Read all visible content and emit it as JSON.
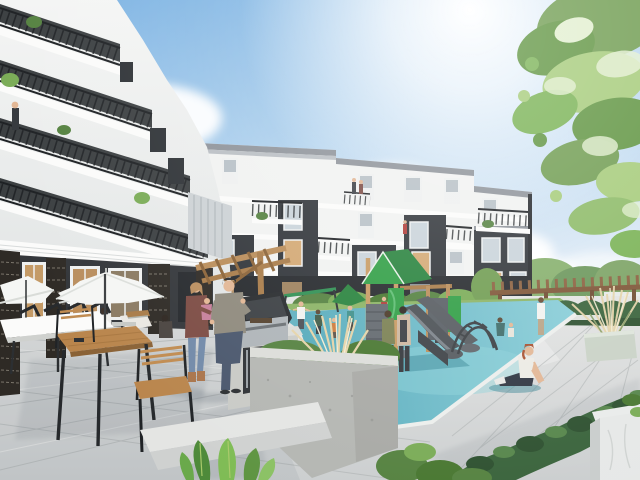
{
  "image": {
    "kind": "architectural-rendering",
    "description": "Sunlit courtyard of a modern four-storey apartment complex: white wing with cascading black-railed balconies at left, white-and-charcoal apartment block behind, patio with white umbrellas, tables and outdoor barbecue, children's playground with green-roofed timber play structure and double slide on blue rubber surfacing, wood pergola and hedges at right, tree canopy overhanging from the top right under a bright sun"
  },
  "palette": {
    "sky_top": "#79b1e2",
    "sky_mid": "#a8cdec",
    "sky_horizon": "#ddeaf6",
    "sun_glare": "#ffffff",
    "cloud": "#f6fafd",
    "building_white": "#f1f2f1",
    "building_bright": "#fbfbfa",
    "building_shade": "#dfe3e4",
    "charcoal": "#2f3338",
    "charcoal_dark": "#24272b",
    "parapet_gray": "#8d9299",
    "railing_black": "#1c1f22",
    "window_glass": "#c9d3da",
    "window_blind": "#b7c0c6",
    "window_frame": "#eef0f0",
    "window_lit": "#d3a873",
    "brick_dark": "#2e2a25",
    "brick_mortar": "#c8c0b2",
    "siding_gray": "#ccd1d4",
    "paver_light": "#d9dbdb",
    "paver_joint": "#a9aeae",
    "paver_sunlit": "#ecedec",
    "ground_shade": "#5a6570",
    "playground_blue": "#69b9c6",
    "playground_blue_deep": "#4fa6b6",
    "playground_blue_light": "#8ed2da",
    "play_green": "#2f9e44",
    "play_green_dark": "#27823c",
    "wood_post": "#c89a62",
    "wood_dark": "#a87b48",
    "slide_gray": "#4a4f54",
    "slide_gray_light": "#7b8289",
    "pergola_wood": "#8a5f3d",
    "lawn_green": "#8ab364",
    "bush_green": "#54813f",
    "bush_green_light": "#79ab55",
    "hedge_green": "#38623a",
    "tree_green": "#6f9c50",
    "tree_green_light": "#a5cb79",
    "tree_green_pale": "#e2efcf",
    "branch_brown": "#5d4228",
    "planter_concrete": "#c6c8c4",
    "planter_sage": "#c9d2c6",
    "marble_white": "#e9ebea",
    "grass_plume": "#e4d3a8",
    "daisy_white": "#ffffff",
    "umbrella_white": "#f5f6f4",
    "table_wood": "#b9854c",
    "skin": "#e2b694",
    "man_shirt": "#8e897c",
    "man_jeans": "#49566c",
    "woman_cardigan": "#7c4b43",
    "woman_jeans": "#7189a8",
    "toddler_pink": "#c77f9b",
    "sitting_hair_auburn": "#a8502f",
    "grill_steel": "#aeb4b8",
    "grill_black": "#26292c"
  },
  "scene": {
    "sky": {
      "label": "blue sky with bright sun glare and soft clouds"
    },
    "left_building": {
      "label": "white apartment wing with cascading black-railed balconies seen from below"
    },
    "center_building": {
      "label": "four-storey apartment block with alternating white and charcoal bays, balconies and windows"
    },
    "tree": {
      "label": "leafy tree canopy overhanging from the top right corner"
    },
    "courtyard": {
      "label": "grey paver patio with white umbrellas, wood dining tables, chairs and a white community table"
    },
    "outdoor_kitchen": {
      "label": "built-in stainless barbecue grill in a stone counter beneath a slatted wood shade"
    },
    "playground": {
      "label": "timber play tower with green gable roof, grey double slide and steel climbing arch on blue safety surfacing"
    },
    "pergola": {
      "label": "wood pergola above a dark clipped hedge"
    },
    "planters": {
      "label": "concrete and stone planters with white daisies, ornamental grasses and shrubs"
    },
    "people": {
      "label": "residents: man at the grill, woman carrying a toddler, diners under umbrellas, children playing, two women watching, woman seated on the play surface"
    }
  }
}
